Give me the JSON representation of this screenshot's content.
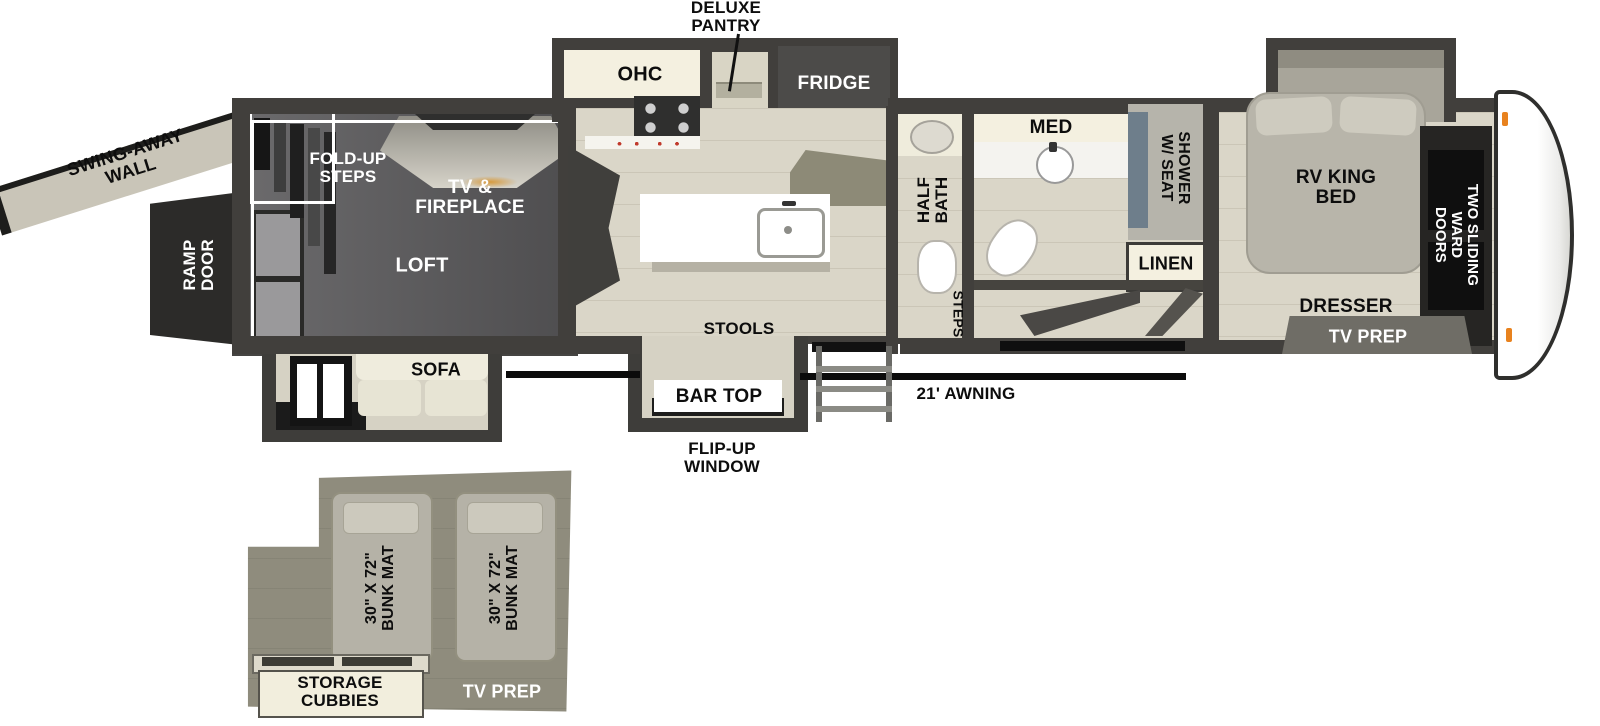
{
  "plan": {
    "exterior": {
      "swing_away_wall": "SWING-AWAY WALL",
      "ramp_door": "RAMP DOOR",
      "awning": "21' AWNING",
      "flip_up_window": "FLIP-UP WINDOW"
    },
    "garage": {
      "fold_up_steps": "FOLD-UP STEPS",
      "tv_fireplace": "TV & FIREPLACE",
      "loft": "LOFT",
      "sofa": "SOFA"
    },
    "kitchen": {
      "deluxe_pantry": "DELUXE PANTRY",
      "ohc": "OHC",
      "fridge": "FRIDGE",
      "stools": "STOOLS",
      "bar_top": "BAR TOP"
    },
    "bath": {
      "half_bath": "HALF BATH",
      "med": "MED",
      "shower_w_seat": "SHOWER W/ SEAT",
      "linen": "LINEN",
      "steps": "STEPS"
    },
    "bedroom": {
      "rv_king_bed": "RV KING BED",
      "two_sliding_ward_doors": "TWO SLIDING WARD DOORS",
      "dresser": "DRESSER",
      "tv_prep": "TV PREP"
    },
    "loft_inset": {
      "bunk_mat_left": "30\" X 72\" BUNK MAT",
      "bunk_mat_right": "30\" X 72\" BUNK MAT",
      "storage_cubbies": "STORAGE CUBBIES",
      "tv_prep": "TV PREP"
    }
  },
  "palette": {
    "wall": "#413f3c",
    "floor": "#dad6c8",
    "garage_floor": "#5a595b",
    "loft_floor": "#8f8c7d",
    "cream_cabinet": "#f4f0e0",
    "dark_furniture": "#2c2b29",
    "awning_line": "#0b0b0b",
    "marker_light": "#e8821e"
  }
}
